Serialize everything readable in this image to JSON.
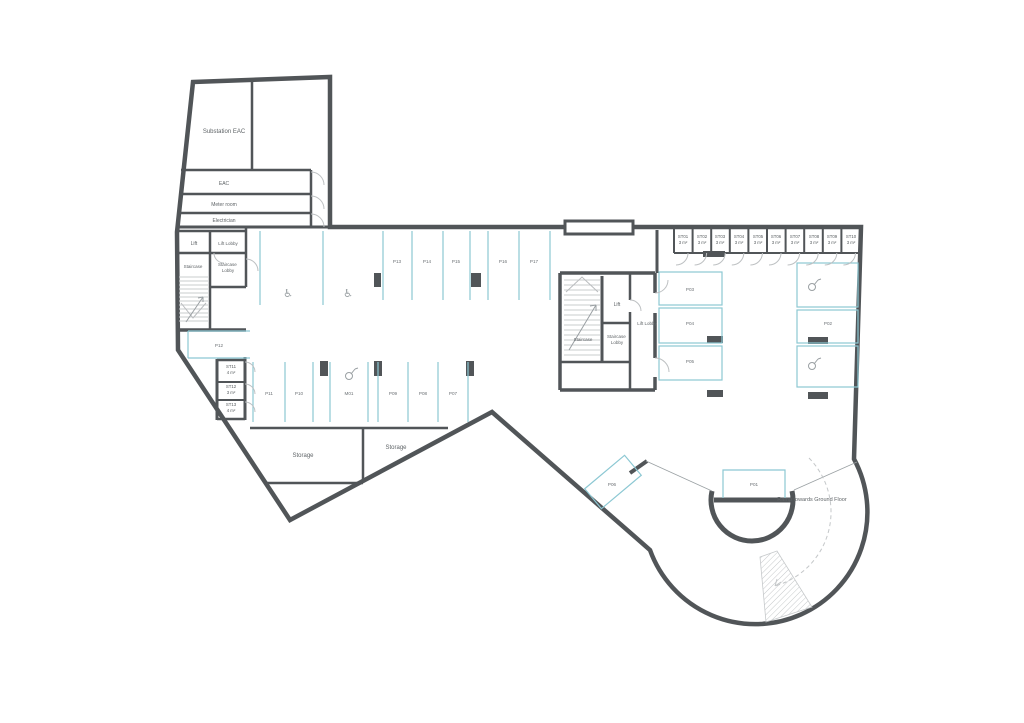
{
  "plan": {
    "title": "Basement parking floor plan",
    "rooms": {
      "substation": "Substation EAC",
      "eac": "EAC",
      "meter": "Meter room",
      "electrician": "Electrician",
      "lift_w": "Lift",
      "lift_lobby_w": "Lift Lobby",
      "staircase_w": "Staircase",
      "staircase_lobby_w_1": "Staircase",
      "staircase_lobby_w_2": "Lobby",
      "staircase_c": "Staircase",
      "staircase_lobby_c_1": "Staircase",
      "staircase_lobby_c_2": "Lobby",
      "lift_c": "Lift",
      "lift_lobby_c": "Lift Lobby",
      "storage1": "Storage",
      "storage2": "Storage",
      "ramp": "Ramp towards Ground Floor"
    },
    "stores": [
      {
        "id": "ST01",
        "area": "3 m²"
      },
      {
        "id": "ST02",
        "area": "3 m²"
      },
      {
        "id": "ST03",
        "area": "3 m²"
      },
      {
        "id": "ST04",
        "area": "3 m²"
      },
      {
        "id": "ST05",
        "area": "3 m²"
      },
      {
        "id": "ST06",
        "area": "3 m²"
      },
      {
        "id": "ST07",
        "area": "3 m²"
      },
      {
        "id": "ST08",
        "area": "3 m²"
      },
      {
        "id": "ST09",
        "area": "3 m²"
      },
      {
        "id": "ST10",
        "area": "3 m²"
      },
      {
        "id": "ST11",
        "area": "4 m²"
      },
      {
        "id": "ST12",
        "area": "3 m²"
      },
      {
        "id": "ST13",
        "area": "4 m²"
      }
    ],
    "parking": {
      "top_row": [
        "P13",
        "P14",
        "P15",
        "P16",
        "P17"
      ],
      "bottom_row": [
        "P11",
        "P10",
        "M01",
        "P09",
        "P08",
        "P07"
      ],
      "corridor": "P12",
      "right_left_col": [
        "P03",
        "P04",
        "P05"
      ],
      "right_right_col": "P02",
      "circle_space": "P01",
      "angled_space": "P06"
    },
    "icons": {
      "accessible": "♿"
    },
    "colors": {
      "wall": "#515558",
      "parking_line": "#8cc8d3",
      "door_arc": "#bdc0c2",
      "stair_line": "#c9ccce",
      "text": "#5f6467"
    }
  }
}
